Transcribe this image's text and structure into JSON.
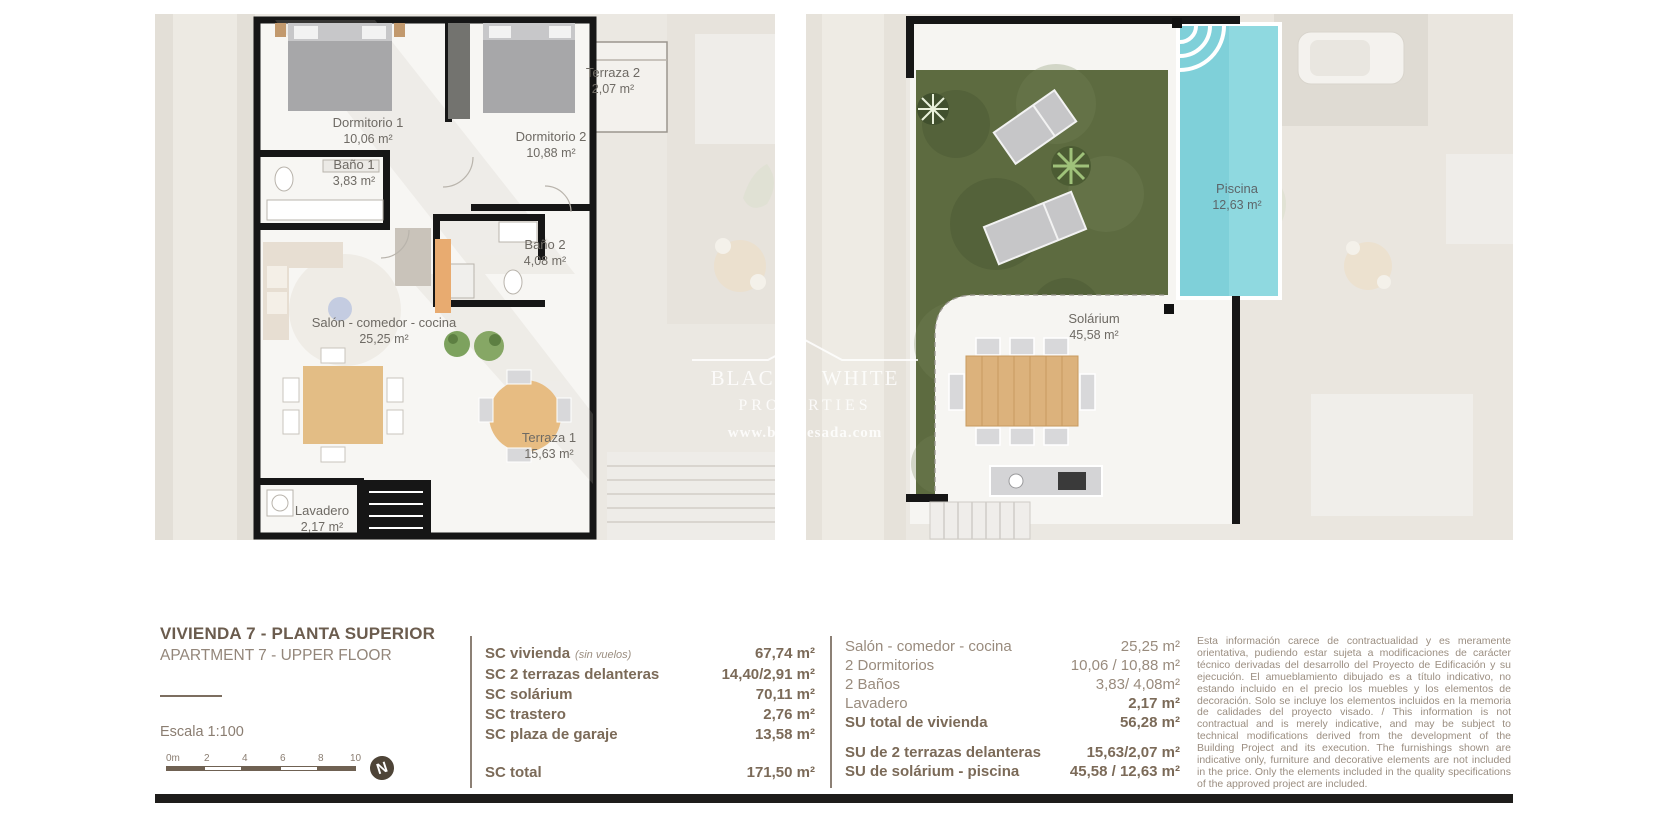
{
  "plans": {
    "left": {
      "rooms": [
        {
          "name": "Dormitorio 1",
          "area": "10,06 m²"
        },
        {
          "name": "Dormitorio 2",
          "area": "10,88 m²"
        },
        {
          "name": "Terraza 2",
          "area": "2,07 m²"
        },
        {
          "name": "Baño 1",
          "area": "3,83 m²"
        },
        {
          "name": "Baño 2",
          "area": "4,08 m²"
        },
        {
          "name": "Salón - comedor - cocina",
          "area": "25,25 m²"
        },
        {
          "name": "Terraza 1",
          "area": "15,63 m²"
        },
        {
          "name": "Lavadero",
          "area": "2,17 m²"
        }
      ]
    },
    "right": {
      "rooms": [
        {
          "name": "Piscina",
          "area": "12,63 m²"
        },
        {
          "name": "Solárium",
          "area": "45,58 m²"
        }
      ]
    }
  },
  "watermark": {
    "brand_left": "BLACK",
    "brand_right": "WHITE",
    "brand_sub": "PROPERTIES",
    "brand_url": "www.bwquesada.com"
  },
  "info": {
    "title_es": "VIVIENDA 7 - PLANTA SUPERIOR",
    "title_en": "APARTMENT 7 - UPPER FLOOR",
    "scale_label": "Escala  1:100",
    "scale_ticks": [
      "0m",
      "2",
      "4",
      "6",
      "8",
      "10"
    ],
    "north": "N"
  },
  "sc_table": {
    "rows": [
      {
        "label": "SC vivienda",
        "note": "(sin vuelos)",
        "value": "67,74 m²"
      },
      {
        "label": "SC 2 terrazas delanteras",
        "note": "",
        "value": "14,40/2,91 m²"
      },
      {
        "label": "SC solárium",
        "note": "",
        "value": "70,11 m²"
      },
      {
        "label": "SC trastero",
        "note": "",
        "value": "2,76 m²"
      },
      {
        "label": "SC plaza de garaje",
        "note": "",
        "value": "13,58 m²"
      }
    ],
    "total": {
      "label": "SC total",
      "value": "171,50 m²"
    }
  },
  "su_table": {
    "rows": [
      {
        "label": "Salón - comedor - cocina",
        "value": "25,25 m²"
      },
      {
        "label": "2 Dormitorios",
        "value": "10,06 / 10,88 m²"
      },
      {
        "label": "2 Baños",
        "value": "3,83/ 4,08m²"
      },
      {
        "label": "Lavadero",
        "value": "2,17 m²"
      },
      {
        "label": "SU total de vivienda",
        "value": "56,28 m²"
      }
    ],
    "extra": [
      {
        "label": "SU de 2 terrazas delanteras",
        "value": "15,63/2,07 m²"
      },
      {
        "label": "SU de solárium - piscina",
        "value": "45,58 / 12,63 m²"
      }
    ]
  },
  "disclaimer": "Esta información carece de contractualidad y es meramente orientativa, pudiendo estar sujeta a modificaciones de carácter técnico derivadas del desarrollo del Proyecto de Edificación y su ejecución. El amueblamiento dibujado es a título indicativo, no estando incluido en el precio los muebles y los elementos de decoración. Solo se incluye los elementos incluidos en la memoria de calidades del proyecto visado. / This information is not contractual and is merely indicative, and may be subject to technical modifications derived from the development of the Building Project and its execution. The furnishings shown are indicative only, furniture and decorative elements are not included in the price. Only the elements included in the quality specifications of the approved project are included.",
  "colors": {
    "wall": "#161616",
    "pool": "#7fd0d9",
    "grass": "#5d6b40",
    "text_dark": "#6b5c4e",
    "text_light": "#998b7d",
    "plan_bg": "#ebe8e2"
  }
}
